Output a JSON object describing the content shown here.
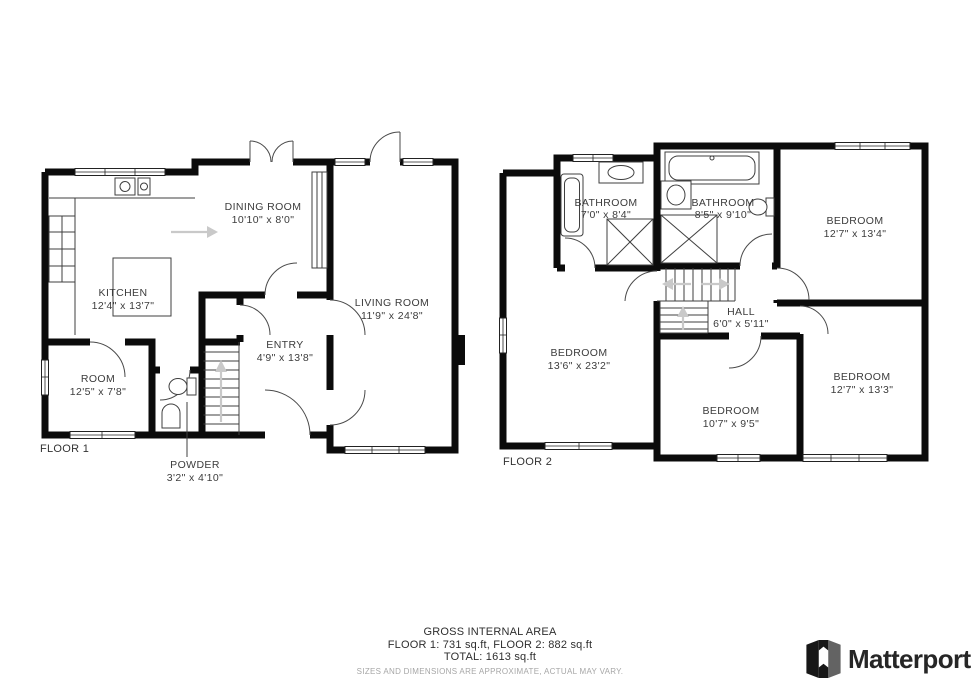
{
  "floor1": {
    "label": "FLOOR 1",
    "rooms": [
      {
        "id": "dining-room",
        "name": "DINING ROOM",
        "dims": "10'10\" x 8'0\""
      },
      {
        "id": "kitchen",
        "name": "KITCHEN",
        "dims": "12'4\" x 13'7\""
      },
      {
        "id": "living-room",
        "name": "LIVING ROOM",
        "dims": "11'9\" x 24'8\""
      },
      {
        "id": "entry",
        "name": "ENTRY",
        "dims": "4'9\" x 13'8\""
      },
      {
        "id": "room",
        "name": "ROOM",
        "dims": "12'5\" x 7'8\""
      },
      {
        "id": "powder",
        "name": "POWDER",
        "dims": "3'2\" x 4'10\""
      }
    ]
  },
  "floor2": {
    "label": "FLOOR 2",
    "rooms": [
      {
        "id": "bathroom-1",
        "name": "BATHROOM",
        "dims": "7'0\" x 8'4\""
      },
      {
        "id": "bathroom-2",
        "name": "BATHROOM",
        "dims": "8'5\" x 9'10\""
      },
      {
        "id": "bedroom-top-right",
        "name": "BEDROOM",
        "dims": "12'7\" x 13'4\""
      },
      {
        "id": "bedroom-left",
        "name": "BEDROOM",
        "dims": "13'6\" x 23'2\""
      },
      {
        "id": "hall",
        "name": "HALL",
        "dims": "6'0\" x 5'11\""
      },
      {
        "id": "bedroom-bottom-middle",
        "name": "BEDROOM",
        "dims": "10'7\" x 9'5\""
      },
      {
        "id": "bedroom-bottom-right",
        "name": "BEDROOM",
        "dims": "12'7\" x 13'3\""
      }
    ]
  },
  "footer": {
    "title": "GROSS INTERNAL AREA",
    "areas": "FLOOR 1: 731 sq.ft, FLOOR 2: 882 sq.ft",
    "total": "TOTAL: 1613 sq.ft",
    "disclaimer": "SIZES AND DIMENSIONS ARE APPROXIMATE, ACTUAL MAY VARY."
  },
  "logo": {
    "text": "Matterport",
    "icon": "matterport-m-icon"
  },
  "colors": {
    "wall": "#0b0b0b",
    "label": "#3c3c3c",
    "direction_arrow": "#c9c9c9",
    "disclaimer": "#a6a6a6",
    "logo_text": "#262626",
    "logo_gray_face": "#636363"
  }
}
